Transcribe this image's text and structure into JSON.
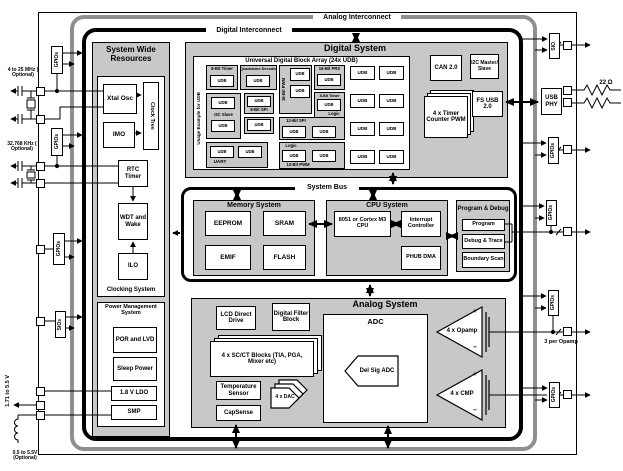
{
  "colors": {
    "section_fill": "#c8c8c8",
    "analog_interconnect_line": "#8f8f8f",
    "digital_interconnect_line": "#000000"
  },
  "interconnect": {
    "analog": "Analog Interconnect",
    "digital": "Digital Interconnect"
  },
  "bus": {
    "label": "System Bus"
  },
  "system_wide": {
    "title": "System Wide Resources",
    "clocking_label": "Clocking System",
    "xtal_osc": "Xtal Osc",
    "clock_tree": "Clock Tree",
    "imo": "IMO",
    "rtc_timer": "RTC Timer",
    "wdt": "WDT and Wake",
    "ilo": "ILO",
    "power_title": "Power Management System",
    "por_lvd": "POR and LVD",
    "sleep_power": "Sleep Power",
    "ldo": "1.8 V LDO",
    "smp": "SMP"
  },
  "digital_system": {
    "title": "Digital System",
    "udb_array_title": "Universal Digital Block Array (24x UDB)",
    "usage_label": "Usage Example for UDB",
    "udb": "UDB",
    "timer8_a": "8-Bit Timer",
    "quadrature": "Quadrature Decoder",
    "i2c_slave": "I2C Slave",
    "spi8": "8-Bit SPI",
    "uart": "UART",
    "pwm16": "16-Bit PWM",
    "prs16": "16-Bit PRS",
    "timer8_b": "8-Bit Timer",
    "logic_a": "Logic",
    "spi12": "12-Bit SPI",
    "logic_b": "Logic",
    "pwm12": "12-Bit PWM",
    "can": "CAN 2.0",
    "i2c_master": "I2C Master/ Slave",
    "timer_pwm": "4 x Timer Counter PWM",
    "fs_usb": "FS USB 2.0"
  },
  "memory": {
    "title": "Memory System",
    "eeprom": "EEPROM",
    "sram": "SRAM",
    "emif": "EMIF",
    "flash": "FLASH"
  },
  "cpu": {
    "title": "CPU System",
    "core": "8051 or Cortex M3 CPU",
    "interrupt": "Interrupt Controller",
    "phub": "PHUB DMA"
  },
  "debug": {
    "title": "Program & Debug",
    "program": "Program",
    "trace": "Debug & Trace",
    "boundary": "Boundary Scan"
  },
  "analog": {
    "title": "Analog System",
    "lcd": "LCD Direct Drive",
    "dfb": "Digital Filter Block",
    "scct": "4 x SC/CT Blocks (TIA, PGA, Mixer etc)",
    "temp": "Temperature Sensor",
    "dac": "4 x DAC",
    "capsense": "CapSense",
    "adc": "ADC",
    "delsig": "Del Sig ADC",
    "opamp": "4 x Opamp",
    "cmp": "4 x CMP",
    "plus": "+",
    "minus": "−"
  },
  "io": {
    "gpios": "GPIOs",
    "sios": "SIOs",
    "sio": "SIO",
    "usb_phy": "USB PHY"
  },
  "external": {
    "xtal_mhz": "4 to 25 MHz ( Optional)",
    "xtal_khz": "32.768 KHz ( Optional)",
    "vdd": "1.71 to 5.5 V",
    "boost": "0.5 to 5.5V (Optional)",
    "usb_resistor": "22 Ω",
    "per_opamp": "3 per Opamp"
  }
}
